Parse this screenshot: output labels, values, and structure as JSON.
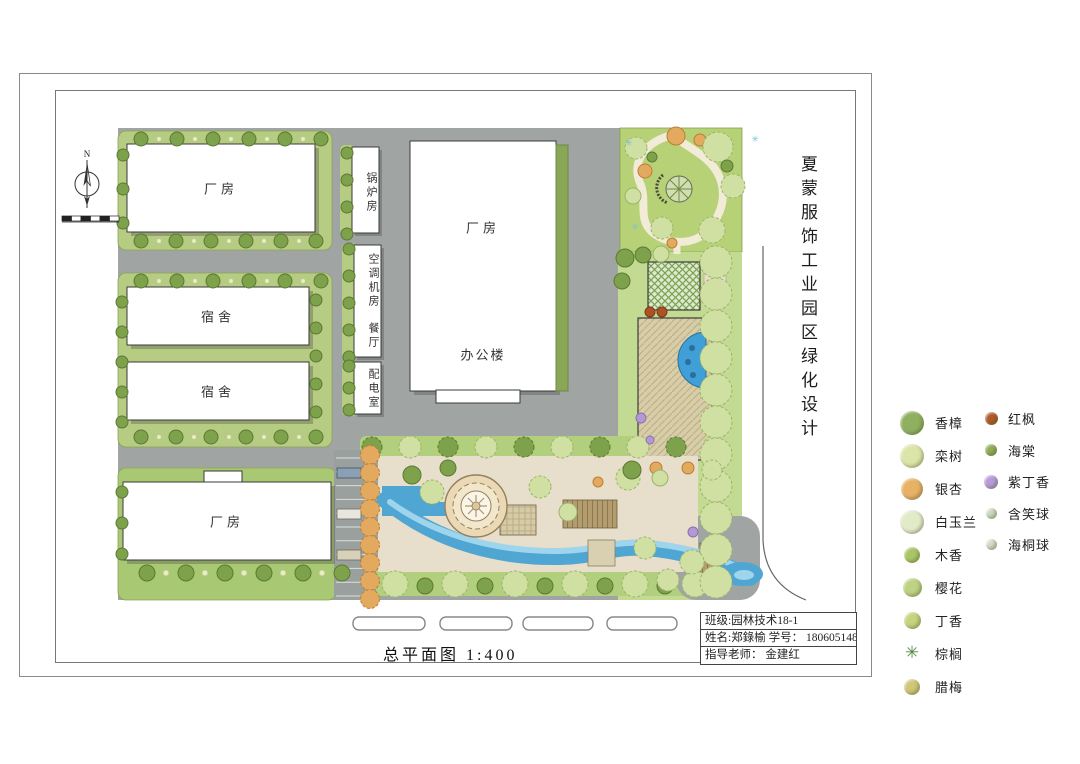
{
  "sheet": {
    "vertical_title": "夏蒙服饰工业园区绿化设计",
    "plan_caption": "总平面图  1:400",
    "north_label": "N"
  },
  "buildings": {
    "factory_top_left": "厂房",
    "dorm_1": "宿舍",
    "dorm_2": "宿舍",
    "factory_bottom": "厂房",
    "factory_main": "厂房",
    "office": "办公楼",
    "boiler_room": "锅炉房",
    "hvac_room": "空调机房",
    "canteen": "餐厅",
    "power_room": "配电室"
  },
  "title_block": {
    "rows": [
      "班级:园林技术18-1",
      "姓名:郑錄榆  学号： 180605148",
      "指导老师： 金建红"
    ]
  },
  "legend": {
    "col1": [
      {
        "label": "香樟",
        "color": "#8fb060",
        "size": 24,
        "shape": "circle"
      },
      {
        "label": "栾树",
        "color": "#dce5a8",
        "size": 24,
        "shape": "circle"
      },
      {
        "label": "银杏",
        "color": "#e7b166",
        "size": 22,
        "shape": "circle"
      },
      {
        "label": "白玉兰",
        "color": "#e2ebc8",
        "size": 24,
        "shape": "circle"
      },
      {
        "label": "木香",
        "color": "#a9c565",
        "size": 16,
        "shape": "circle"
      },
      {
        "label": "樱花",
        "color": "#bdd282",
        "size": 19,
        "shape": "circle"
      },
      {
        "label": "丁香",
        "color": "#c6d37f",
        "size": 17,
        "shape": "circle"
      },
      {
        "label": "棕榈",
        "color": "#55863f",
        "size": 18,
        "shape": "palm"
      },
      {
        "label": "腊梅",
        "color": "#cfc678",
        "size": 16,
        "shape": "circle"
      }
    ],
    "col2": [
      {
        "label": "红枫",
        "color": "#b05a28",
        "size": 13,
        "shape": "circle"
      },
      {
        "label": "海棠",
        "color": "#8fae57",
        "size": 12,
        "shape": "circle"
      },
      {
        "label": "紫丁香",
        "color": "#b79bd8",
        "size": 14,
        "shape": "circle"
      },
      {
        "label": "含笑球",
        "color": "#ccd9c0",
        "size": 11,
        "shape": "circle"
      },
      {
        "label": "海桐球",
        "color": "#d4ddc8",
        "size": 11,
        "shape": "circle"
      }
    ]
  }
}
